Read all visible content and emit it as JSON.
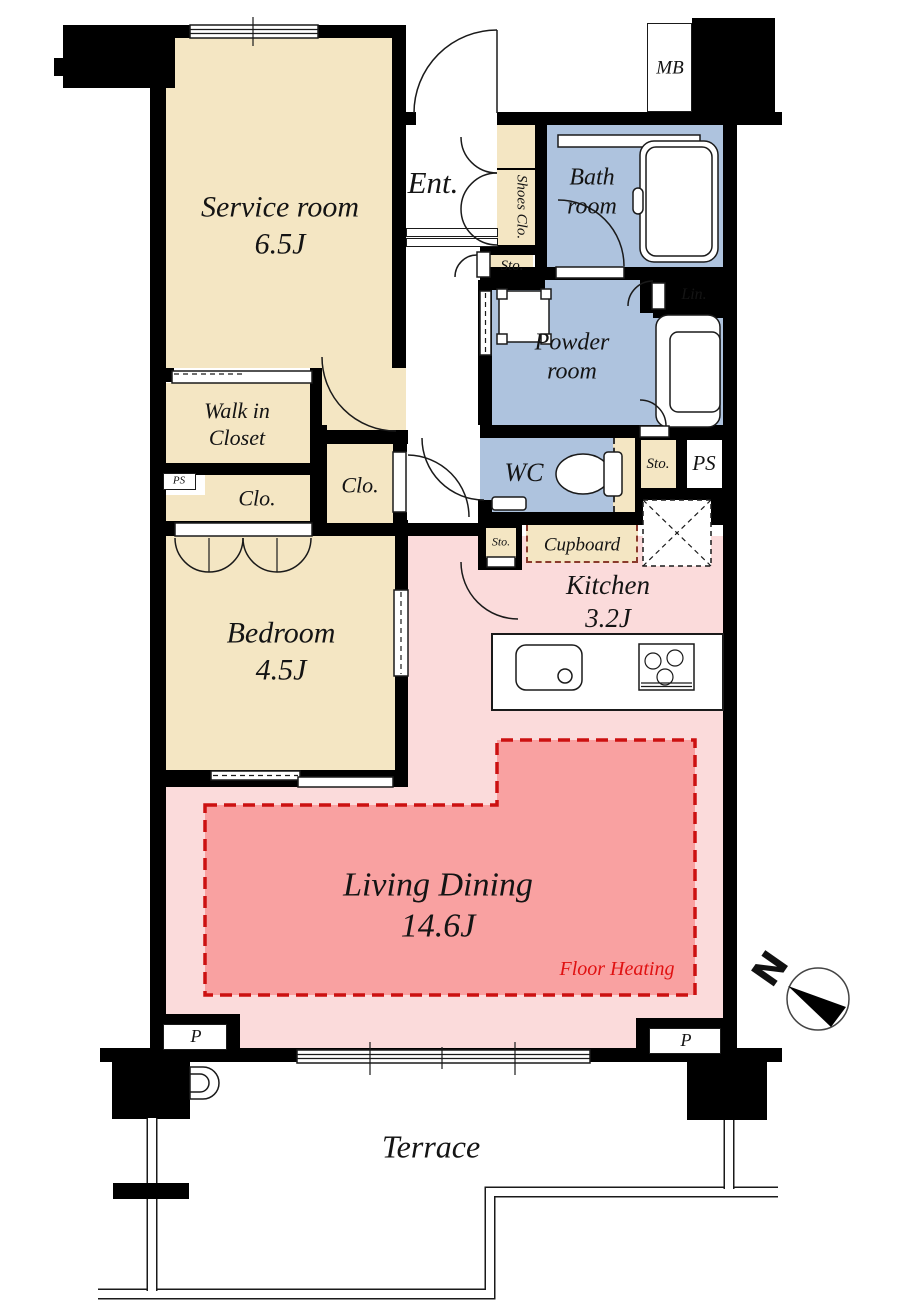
{
  "title": "Apartment floor plan",
  "colors": {
    "wall": "#000000",
    "room_tan": "#F4E6C3",
    "room_blue": "#AEC3DE",
    "room_pink": "#FBDBDB",
    "floor_heating_fill": "#F9A1A1",
    "floor_heating_line": "#CC1111",
    "floor_heating_text": "#E01111",
    "cupboard_dash": "#8A3A2C"
  },
  "rooms": {
    "service": {
      "name": "Service room",
      "size": "6.5J"
    },
    "entrance": {
      "name": "Ent."
    },
    "shoes_closet": {
      "name": "Shoes Clo."
    },
    "storage_entrance": {
      "name": "Sto."
    },
    "meter_box": {
      "name": "MB"
    },
    "bathroom": {
      "line1": "Bath",
      "line2": "room"
    },
    "linen": {
      "name": "Lin."
    },
    "powder": {
      "line1": "Powder",
      "line2": "room"
    },
    "wc": {
      "name": "WC"
    },
    "storage_hall": {
      "name": "Sto."
    },
    "pipe_space_hall": {
      "name": "PS"
    },
    "walk_in_closet": {
      "line1": "Walk in",
      "line2": "Closet"
    },
    "pipe_space_left": {
      "name": "PS"
    },
    "closet_left": {
      "name": "Clo."
    },
    "closet_hall": {
      "name": "Clo."
    },
    "storage_kitchen": {
      "name": "Sto."
    },
    "cupboard": {
      "name": "Cupboard"
    },
    "kitchen": {
      "name": "Kitchen",
      "size": "3.2J"
    },
    "bedroom": {
      "name": "Bedroom",
      "size": "4.5J"
    },
    "living": {
      "name": "Living Dining",
      "size": "14.6J",
      "note": "Floor Heating"
    },
    "pillar_left": {
      "name": "P"
    },
    "pillar_right": {
      "name": "P"
    },
    "terrace": {
      "name": "Terrace"
    },
    "compass": {
      "north": "N"
    }
  }
}
